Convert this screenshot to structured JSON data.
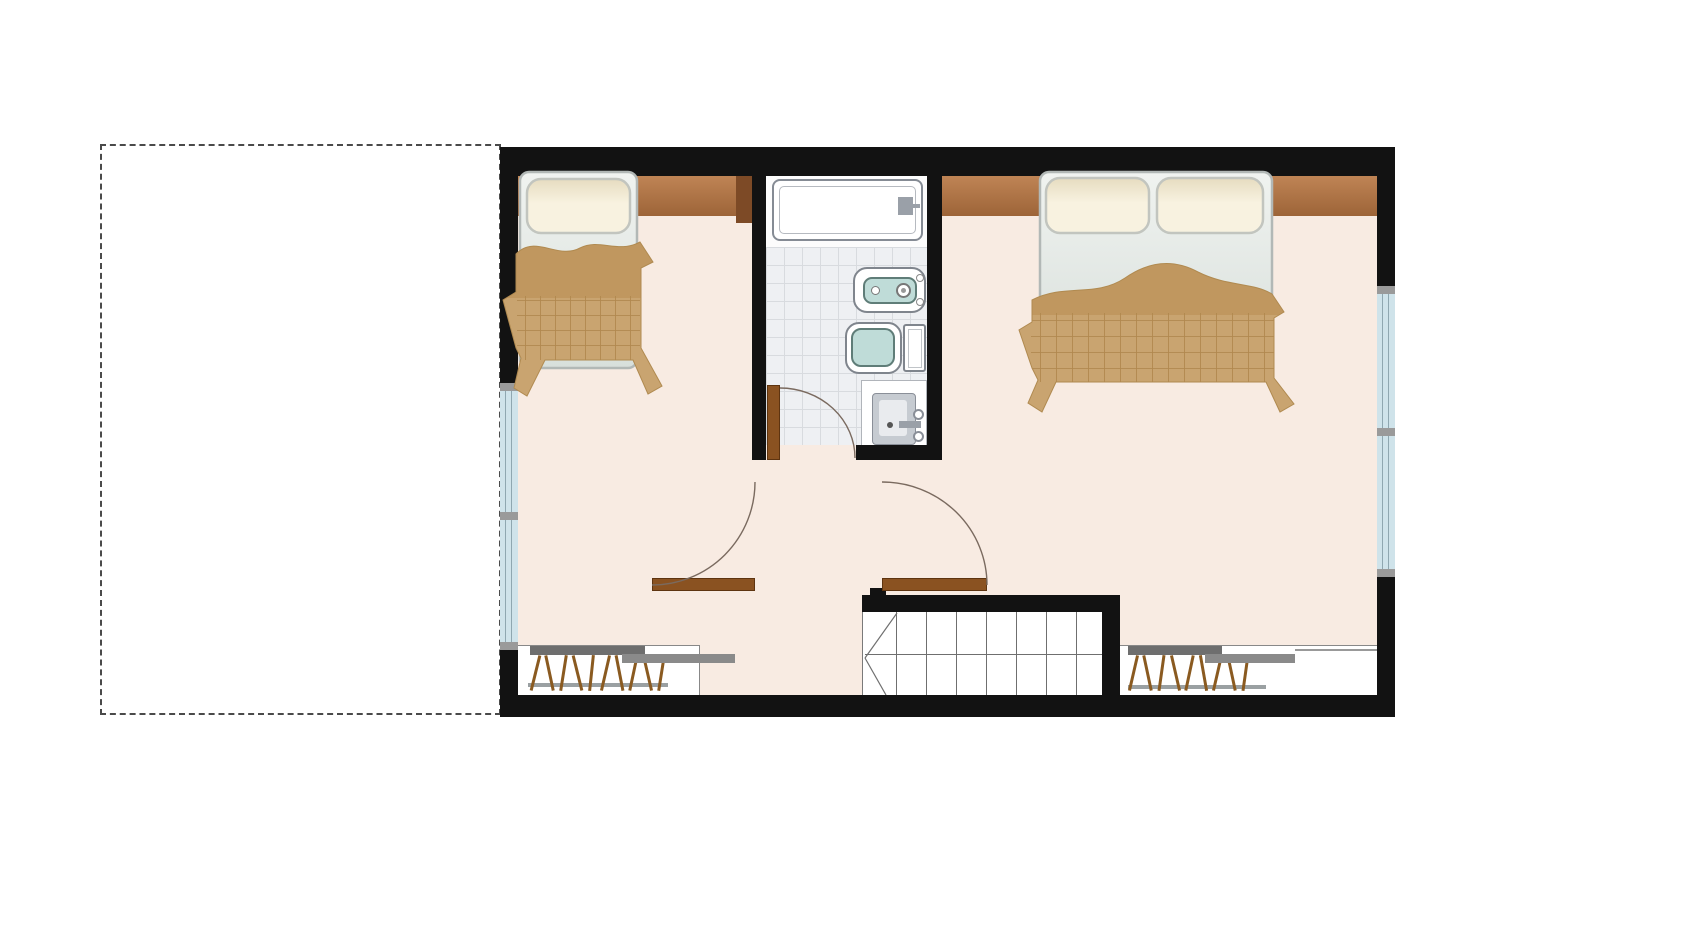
{
  "canvas": {
    "width": 1689,
    "height": 950,
    "background": "#ffffff"
  },
  "colors": {
    "wall": "#121212",
    "floor": "#f8ebe2",
    "tile": "#eef0f3",
    "tile_line": "#d8dbdf",
    "glass": "#cfe3ea",
    "window_frame": "#9a9a9a",
    "band_light": "#bf8455",
    "band_dark": "#9d6438",
    "band_cap": "#7d4a26",
    "door": "#8a5221",
    "blanket": "#c9a470",
    "blanket_fold": "#c0975f",
    "blanket_grid": "#b1884f",
    "mattress": "#e3e8e3",
    "pillow": "#f6eed8",
    "fixture_outline": "#7f858d",
    "fixture_teal": "#bfdcd8",
    "teal_border": "#5f7d78",
    "stair_line": "#6f6f6f",
    "closet_bar_dark": "#6e6e6e",
    "closet_bar_light": "#8a8a8a",
    "closet_rod": "#9aa0a2",
    "hanger": "#8a5a20",
    "swing_arc": "#7a6a5f",
    "dashline": "#4a4a4a"
  },
  "plan": {
    "type": "upper-floor-plan",
    "unbuilt_area": {
      "style": "dashed-outline"
    },
    "rooms": [
      {
        "id": "bedroom-left",
        "furniture": [
          "single-bed",
          "wardrobe-band",
          "closet-with-hangers"
        ]
      },
      {
        "id": "bathroom",
        "fixtures": [
          "bathtub",
          "bidet",
          "toilet",
          "sink-vanity"
        ],
        "floor": "tiled"
      },
      {
        "id": "bedroom-right",
        "furniture": [
          "double-bed",
          "wardrobe-band",
          "closet-with-hangers"
        ]
      },
      {
        "id": "hall",
        "features": [
          "two-swing-doors"
        ]
      },
      {
        "id": "staircase",
        "features": [
          "straight-treads",
          "winder-treads"
        ]
      }
    ],
    "windows": [
      {
        "wall": "left",
        "panes": 2
      },
      {
        "wall": "right",
        "panes": 2
      }
    ],
    "doors": [
      {
        "to": "bathroom",
        "type": "hinged-with-swing-arc"
      },
      {
        "to": "hall-left",
        "type": "hinged-with-swing-arc"
      },
      {
        "to": "hall-right",
        "type": "hinged-with-swing-arc"
      }
    ]
  },
  "stairs": {
    "tread_count": 7,
    "first_x": 895,
    "spacing": 30,
    "winder_count": 2
  },
  "closets": {
    "left": {
      "hanger_count": 10,
      "hanger_step": 14,
      "tilts": [
        14,
        -12,
        9,
        -14,
        6,
        13,
        -11,
        12,
        -13,
        9
      ]
    },
    "right": {
      "hanger_count": 9,
      "hanger_step": 14,
      "tilts": [
        13,
        -12,
        8,
        -13,
        12,
        -10,
        13,
        -12,
        8
      ]
    }
  }
}
